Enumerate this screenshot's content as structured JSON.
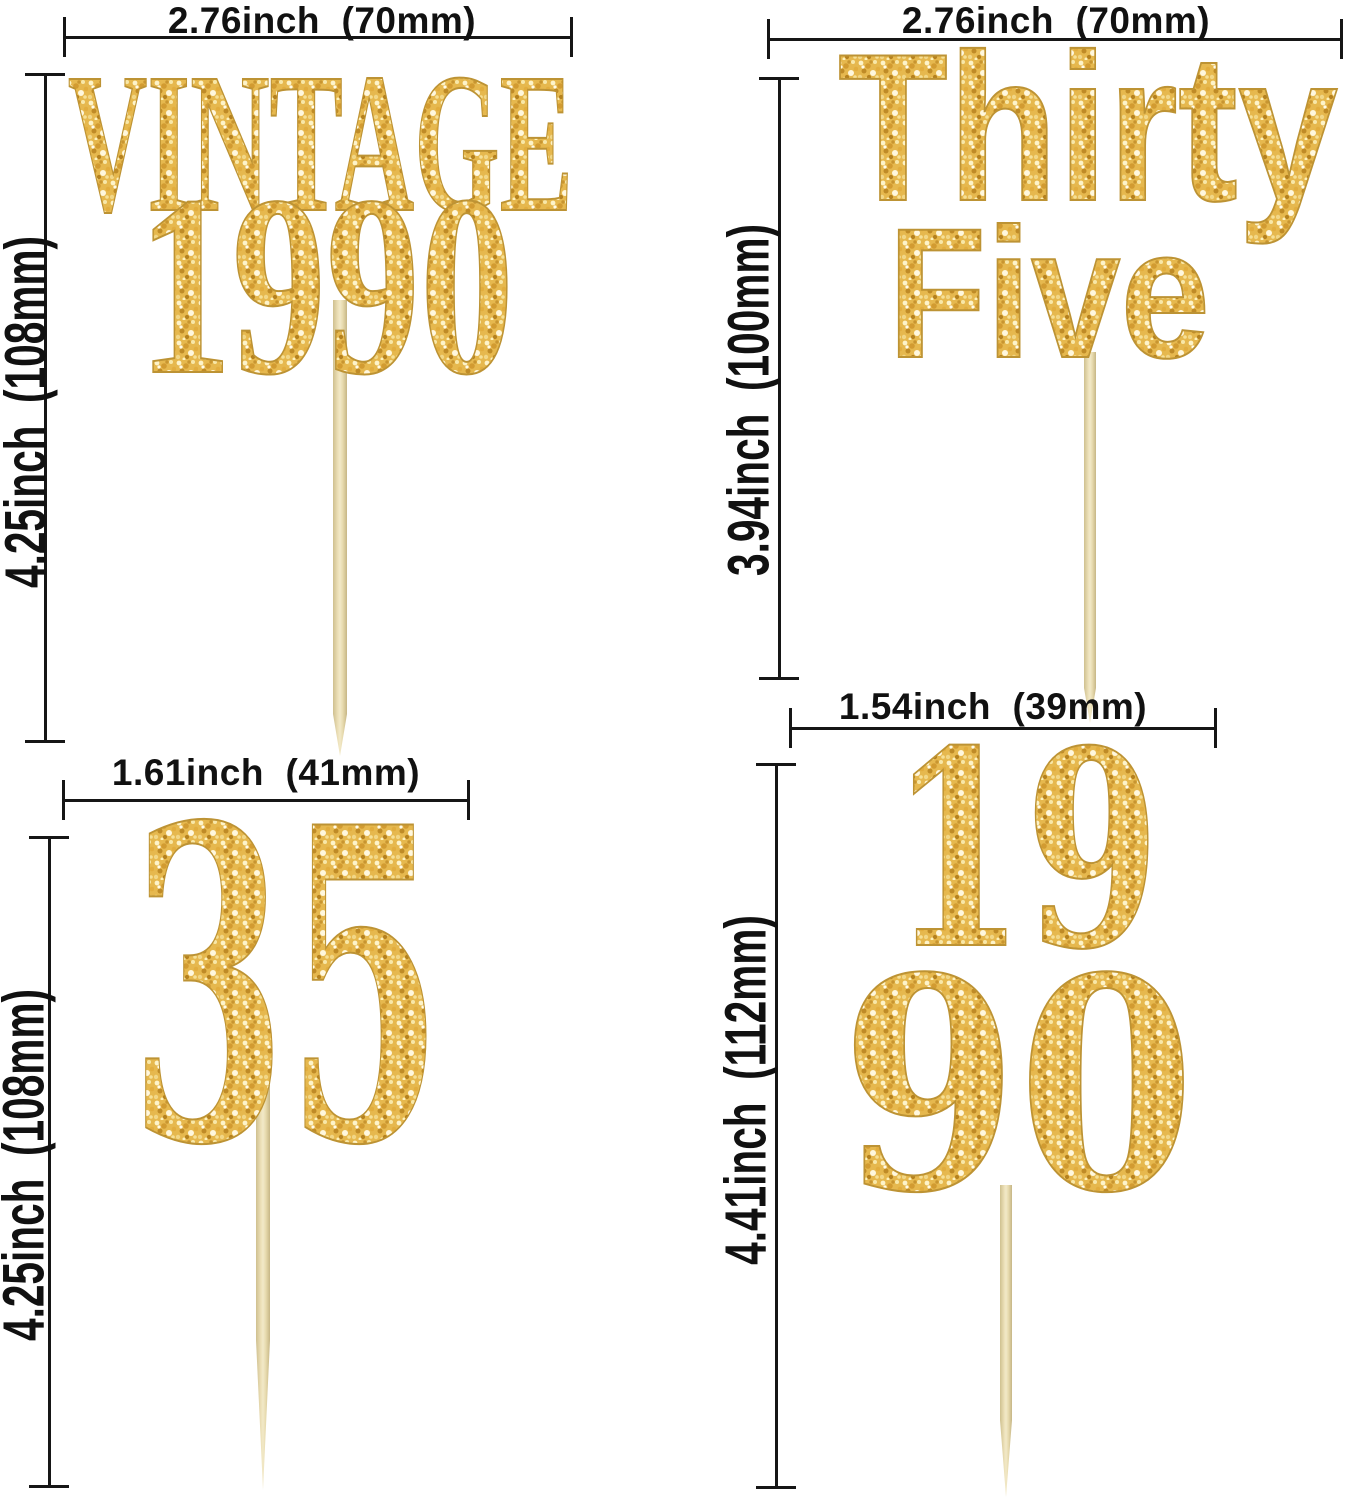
{
  "image": {
    "description": "Gold glitter cupcake topper size chart with four toppers on wooden toothpicks and dimension lines",
    "background": "#ffffff"
  },
  "colors": {
    "dimension_line": "#161616",
    "label_text": "#111111",
    "gold_base": "#e6b84e",
    "gold_light": "#fdf3c9",
    "gold_dark": "#bf8b27",
    "gold_outline": "#bd9334",
    "wood_light": "#f2e9c8",
    "wood_mid": "#e7daae",
    "wood_dark": "#cfc08f"
  },
  "panels": [
    {
      "name": "vintage-1990",
      "width_label": "2.76inch  (70mm)",
      "height_label": "4.25inch  (108mm)",
      "topper": {
        "line1": "VINTAGE",
        "line2": "1990"
      }
    },
    {
      "name": "thirty-five-words",
      "width_label": "2.76inch  (70mm)",
      "height_label": "3.94inch  (100mm)",
      "topper": {
        "line1": "Thirty",
        "line2": "Five"
      }
    },
    {
      "name": "thirty-five-numeral",
      "width_label": "1.61inch  (41mm)",
      "height_label": "4.25inch  (108mm)",
      "topper": {
        "line1": "35"
      }
    },
    {
      "name": "nineteen-ninety-stacked",
      "width_label": "1.54inch  (39mm)",
      "height_label": "4.41inch  (112mm)",
      "topper": {
        "line1": "19",
        "line2": "90"
      }
    }
  ]
}
